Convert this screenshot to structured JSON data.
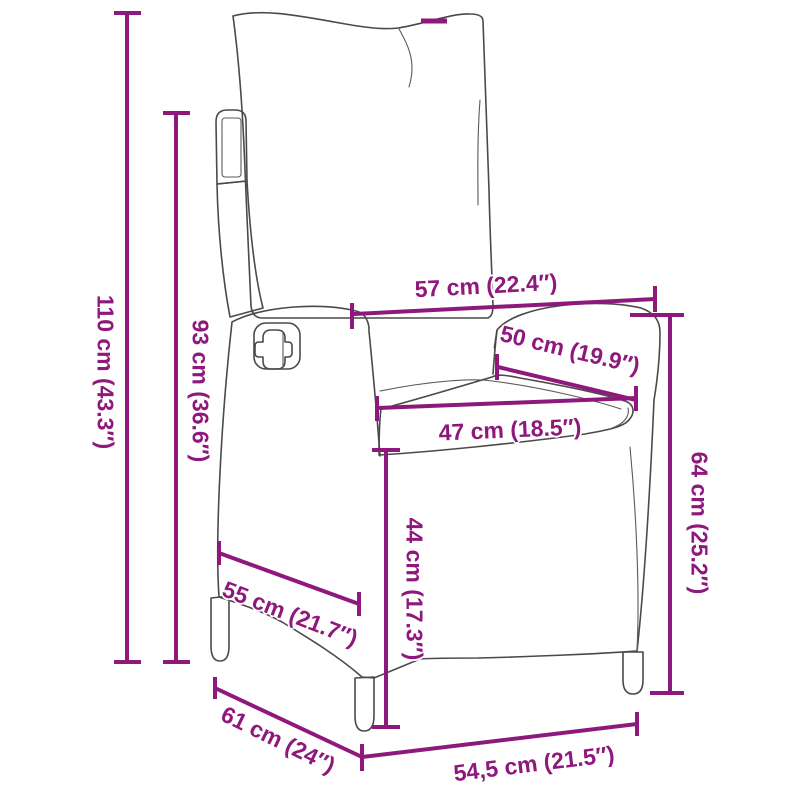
{
  "figure": {
    "alt": "Line drawing of a reclining rattan garden chair with back and seat cushions, annotated with product dimensions"
  },
  "colors": {
    "dimension_accent": "#8E187C",
    "drawing_outline": "#4a4a4a",
    "rattan_texture": "#8f8f8f"
  },
  "measurements": [
    {
      "name": "overall-height",
      "label": "110 cm (43.3″)"
    },
    {
      "name": "backrest-height",
      "label": "93 cm (36.6″)"
    },
    {
      "name": "top-width",
      "label": "57 cm (22.4″)"
    },
    {
      "name": "armrest-depth",
      "label": "50 cm (19.9″)"
    },
    {
      "name": "seat-width",
      "label": "47 cm (18.5″)"
    },
    {
      "name": "armrest-height",
      "label": "64 cm (25.2″)"
    },
    {
      "name": "seat-height",
      "label": "44 cm (17.3″)"
    },
    {
      "name": "base-depth",
      "label": "55 cm (21.7″)"
    },
    {
      "name": "overall-depth",
      "label": "61 cm (24″)"
    },
    {
      "name": "front-width",
      "label": "54,5 cm (21.5″)"
    }
  ]
}
